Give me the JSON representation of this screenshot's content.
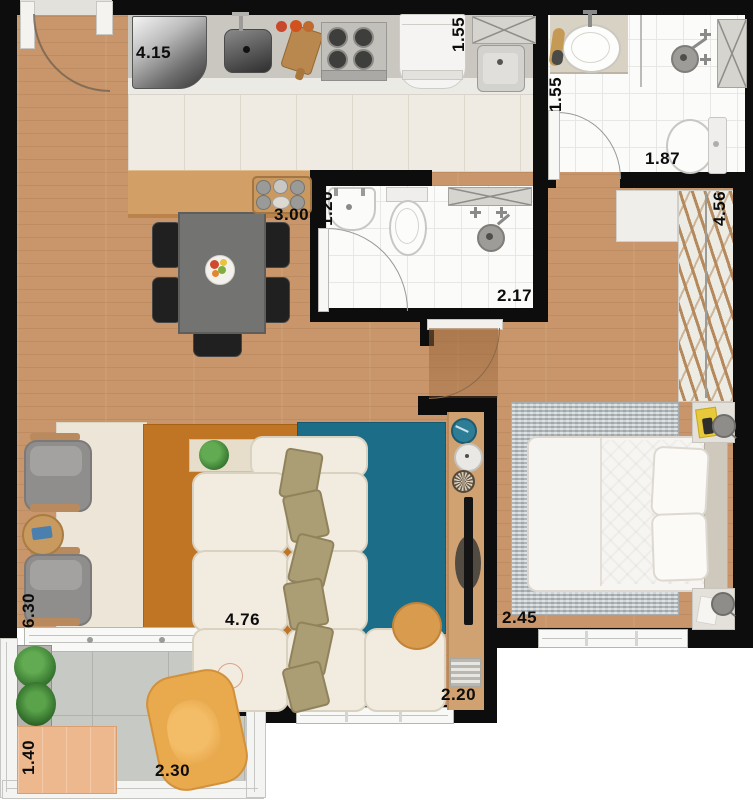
{
  "title": "apartment-floor-plan",
  "dimensions": {
    "kitchen_counter": "4.15",
    "laundry_width": "1.55",
    "bath1_width": "1.55",
    "bath1_length": "1.87",
    "bath2_width": "1.20",
    "bath2_length": "2.17",
    "kitchen_bar": "3.00",
    "closet_length": "4.56",
    "living_length": "6.30",
    "living_width": "4.76",
    "bedroom_width": "2.45",
    "tv_wall": "2.20",
    "balcony_depth": "1.40",
    "balcony_width": "2.30"
  },
  "palette": {
    "wall": "#0d0d0d",
    "wood_floor": "#c8966a",
    "kitchen_tile": "#f0ebe2",
    "bath_tile": "#fbfbfa",
    "balcony_tile": "#c7c9c5",
    "counter_gray": "#cac7c1",
    "bar_wood": "#d2a066",
    "rug_cream": "#ede6d8",
    "rug_orange": "#bf7524",
    "rug_teal": "#1c6e88",
    "rug_bedroom_gray": "#bdc3c5",
    "sofa_cream": "#f2ece0",
    "pillow_khaki": "#ab9d74",
    "armchair_gray": "#8f8e8c",
    "dining_chair_black": "#1f1f1f",
    "balcony_chair_yellow": "#e9a94d",
    "plate_teal": "#2e7d96",
    "plant_green": "#3f8f3a"
  }
}
